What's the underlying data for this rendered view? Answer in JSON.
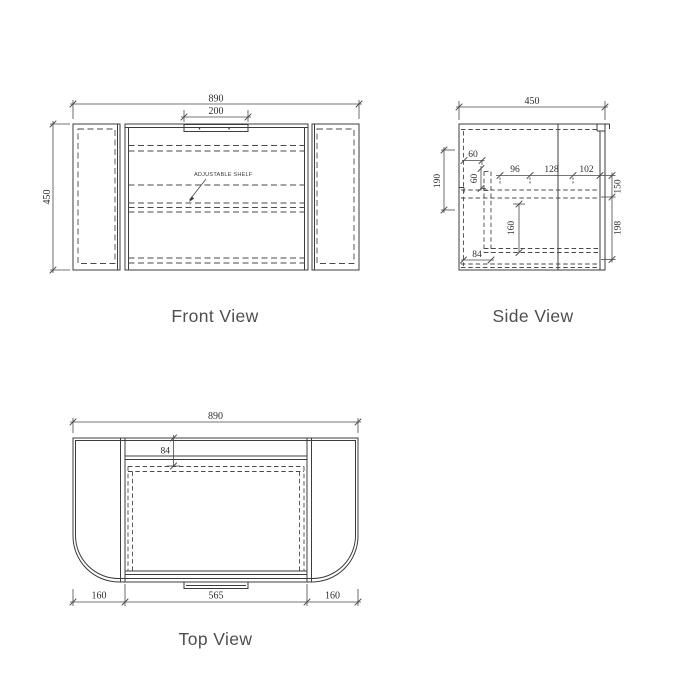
{
  "style": {
    "background": "#ffffff",
    "line_color": "#3c3c3c",
    "dim_color": "#474747",
    "text_color": "#2e2e2e",
    "label_color": "#4f4f4f"
  },
  "front_view": {
    "label": "Front View",
    "dim_overall_width": "890",
    "dim_handle_width": "200",
    "dim_height": "450",
    "annotation_adjustable_shelf": "ADJUSTABLE SHELF"
  },
  "side_view": {
    "label": "Side View",
    "dim_depth": "450",
    "dim_left_height": "190",
    "dim_top_inset": "60",
    "dim_side_inset": "60",
    "dim_span_left": "96",
    "dim_span_middle": "128",
    "dim_span_right": "102",
    "dim_right_upper": "150",
    "dim_right_lower": "198",
    "dim_drawer_height": "160",
    "dim_bottom_inset": "84"
  },
  "top_view": {
    "label": "Top View",
    "dim_overall_width": "890",
    "dim_back_inset": "84",
    "dim_left_wing": "160",
    "dim_center_width": "565",
    "dim_right_wing": "160"
  }
}
